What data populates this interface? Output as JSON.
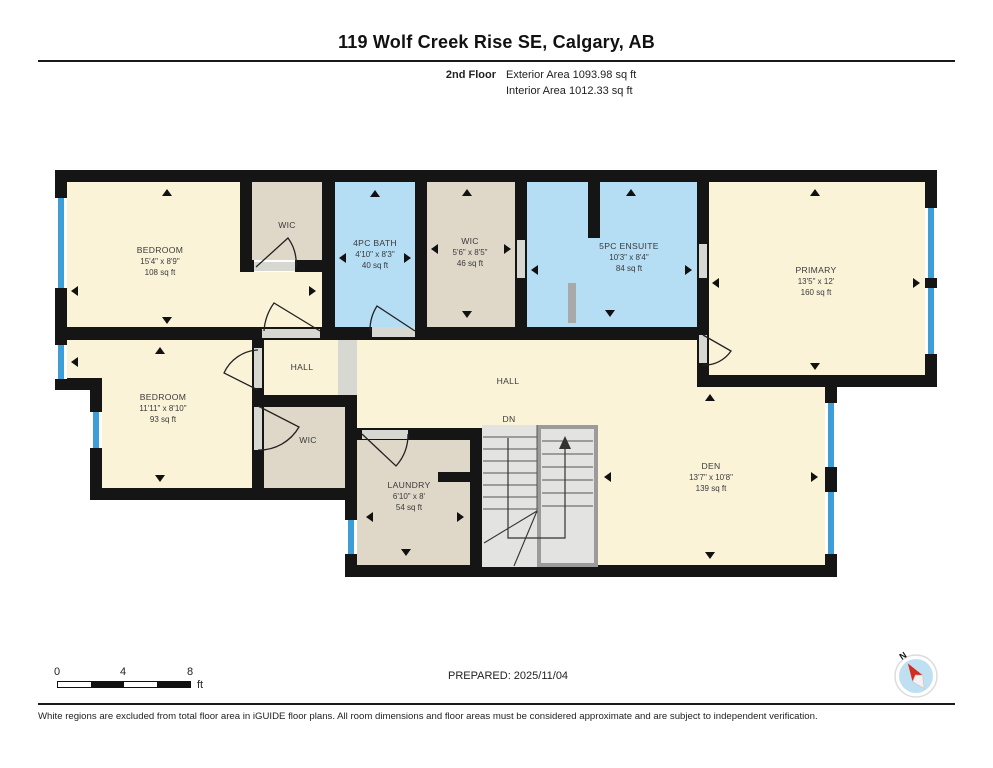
{
  "header": {
    "title": "119 Wolf Creek Rise SE, Calgary, AB",
    "floor_label": "2nd Floor",
    "exterior_area": "Exterior Area 1093.98 sq ft",
    "interior_area": "Interior Area 1012.33 sq ft"
  },
  "rooms": [
    {
      "id": "bedroom-1",
      "name": "BEDROOM",
      "dims": "15'4\" x 8'9\"",
      "area": "108 sq ft"
    },
    {
      "id": "bath-4pc",
      "name": "4PC BATH",
      "dims": "4'10\" x 8'3\"",
      "area": "40 sq ft"
    },
    {
      "id": "wic-upper",
      "name": "WIC",
      "dims": "5'6\" x 8'5\"",
      "area": "46 sq ft"
    },
    {
      "id": "ensuite",
      "name": "5PC ENSUITE",
      "dims": "10'3\" x 8'4\"",
      "area": "84 sq ft"
    },
    {
      "id": "primary",
      "name": "PRIMARY",
      "dims": "13'5\" x 12'",
      "area": "160 sq ft"
    },
    {
      "id": "bedroom-2",
      "name": "BEDROOM",
      "dims": "11'11\" x 8'10\"",
      "area": "93 sq ft"
    },
    {
      "id": "laundry",
      "name": "LAUNDRY",
      "dims": "6'10\" x 8'",
      "area": "54 sq ft"
    },
    {
      "id": "den",
      "name": "DEN",
      "dims": "13'7\" x 10'8\"",
      "area": "139 sq ft"
    }
  ],
  "labels": {
    "wic_top": "WIC",
    "hall_small": "HALL",
    "wic_bottom": "WIC",
    "hall_main": "HALL",
    "stairs_down": "DN"
  },
  "scale_bar": {
    "ticks": [
      "0",
      "4",
      "8"
    ],
    "unit": "ft"
  },
  "compass": {
    "north_label": "N"
  },
  "footer": {
    "prepared": "PREPARED: 2025/11/04",
    "disclaimer": "White regions are excluded from total floor area in iGUIDE floor plans. All room dimensions and floor areas must be considered approximate and are subject to independent verification."
  },
  "colors": {
    "room_cream": "#FAF3D8",
    "room_tan": "#DFD8C8",
    "room_blue": "#B5DDF4",
    "wall": "#151515",
    "window": "#3E9FD8",
    "stair_fill": "#E3E3E1",
    "compass_face": "#BFE0F2",
    "compass_needle": "#D22B1F"
  }
}
